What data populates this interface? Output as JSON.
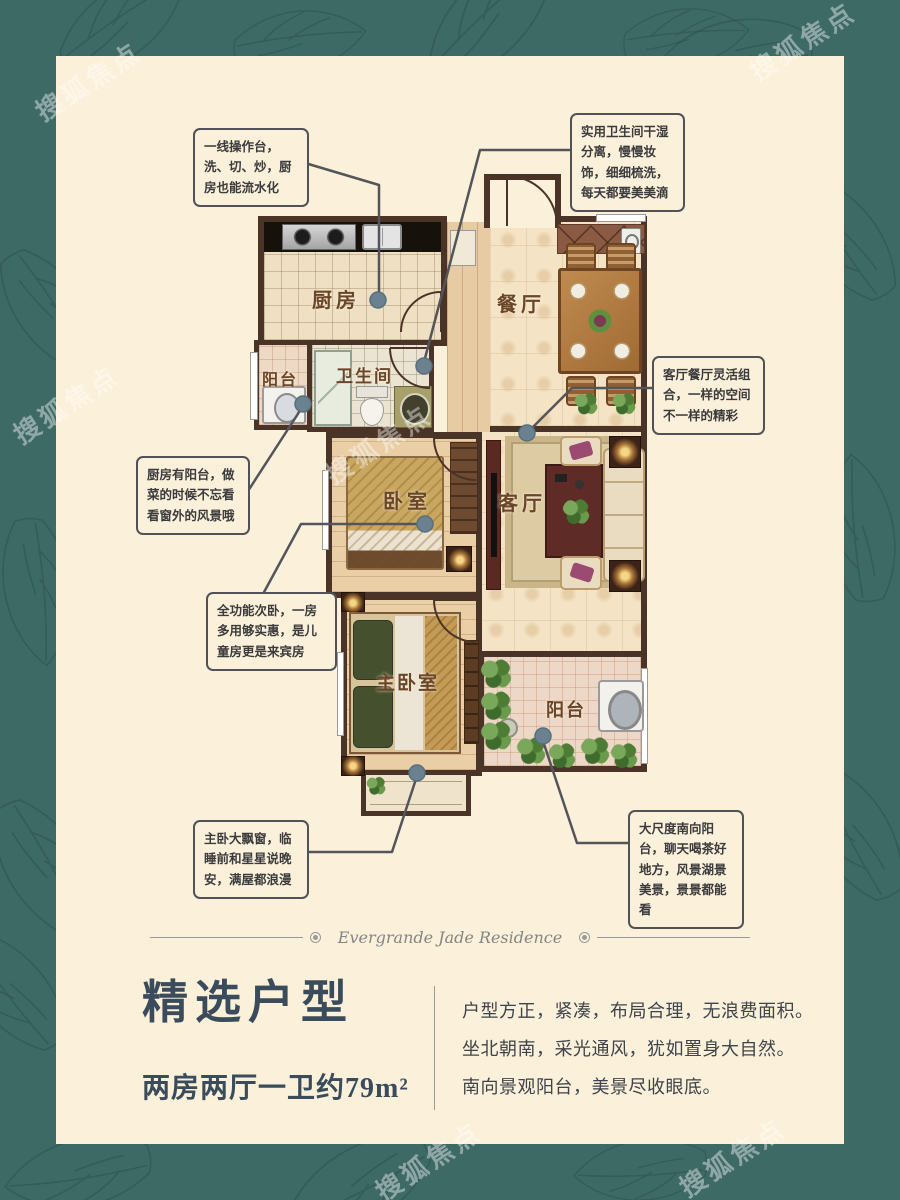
{
  "brand": {
    "watermark": "搜狐焦点"
  },
  "colors": {
    "border_teal": "#3E6A66",
    "panel_cream": "#FBF0D9",
    "wall_brown": "#4A3428",
    "title_slate": "#3A4C5C",
    "callout_border": "#515257",
    "connector_dot": "#6C8190"
  },
  "floorplan": {
    "rooms": [
      {
        "id": "kitchen",
        "label": "厨房"
      },
      {
        "id": "kitchen-balcony",
        "label": "阳台"
      },
      {
        "id": "bathroom",
        "label": "卫生间"
      },
      {
        "id": "dining",
        "label": "餐厅"
      },
      {
        "id": "bedroom",
        "label": "卧室"
      },
      {
        "id": "living",
        "label": "客厅"
      },
      {
        "id": "master-bedroom",
        "label": "主卧室"
      },
      {
        "id": "south-balcony",
        "label": "阳台"
      }
    ]
  },
  "callouts": [
    "一线操作台，洗、切、炒，厨房也能流水化",
    "实用卫生间干湿分离，慢慢妆饰，细细梳洗，每天都要美美滴",
    "客厅餐厅灵活组合，一样的空间不一样的精彩",
    "厨房有阳台，做菜的时候不忘看看窗外的风景哦",
    "全功能次卧，一房多用够实惠，是儿童房更是来宾房",
    "主卧大飘窗，临睡前和星星说晚安，满屋都浪漫",
    "大尺度南向阳台，聊天喝茶好地方，风景湖景美景，景景都能看"
  ],
  "divider": {
    "text": "Evergrande Jade Residence"
  },
  "footer": {
    "title": "精选户型",
    "subtitle": "两房两厅一卫约79m²",
    "description": [
      "户型方正，紧凑，布局合理，无浪费面积。",
      "坐北朝南，采光通风，犹如置身大自然。",
      "南向景观阳台，美景尽收眼底。"
    ]
  }
}
